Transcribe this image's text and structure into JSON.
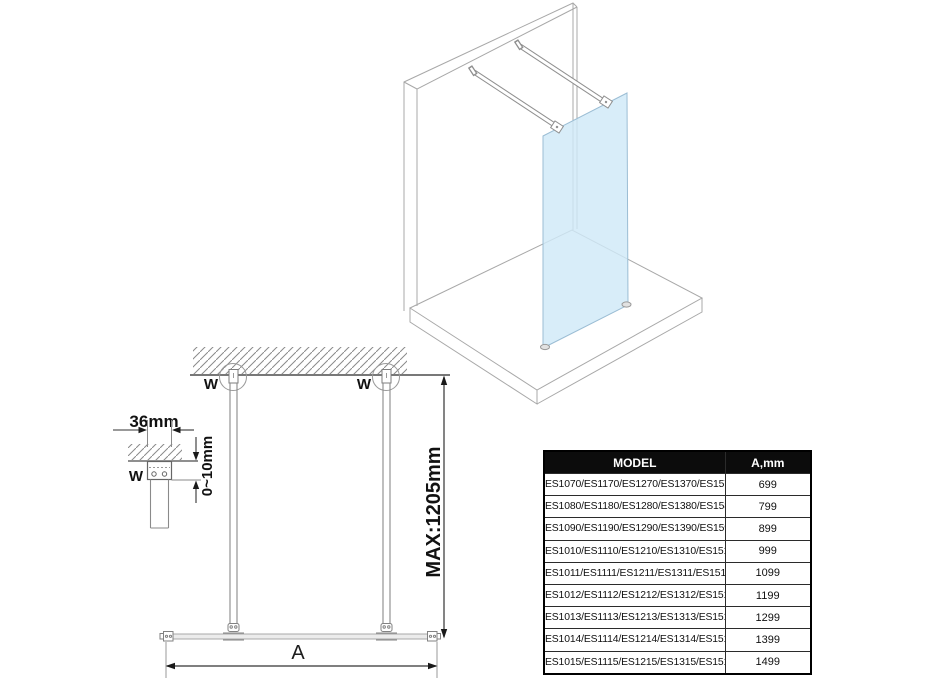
{
  "drawing_3d": {
    "name": "isometric-walk-in-glass-panel",
    "glass_color": "#CFE9F8",
    "outline_color": "#A8A8A8",
    "elements": [
      "wall-slab",
      "floor-slab",
      "glass-panel",
      "support-bar-front",
      "support-bar-back",
      "glass-feet"
    ]
  },
  "drawing_2d": {
    "labels": {
      "wall_mount_left": "W",
      "wall_mount_right": "W",
      "wall_mount_detail": "W",
      "bar_width": "36mm",
      "adjust_range": "0~10mm",
      "max_length": "MAX:1205mm",
      "glass_width": "A"
    }
  },
  "table": {
    "headers": {
      "model": "MODEL",
      "a_mm": "A,mm"
    },
    "header_bg": "#0c0c0c",
    "header_text_color": "#ffffff",
    "rows": [
      {
        "model": "ES1070/ES1170/ES1270/ES1370/ES1570",
        "a_mm": "699"
      },
      {
        "model": "ES1080/ES1180/ES1280/ES1380/ES1580",
        "a_mm": "799"
      },
      {
        "model": "ES1090/ES1190/ES1290/ES1390/ES1590",
        "a_mm": "899"
      },
      {
        "model": "ES1010/ES1110/ES1210/ES1310/ES1510",
        "a_mm": "999"
      },
      {
        "model": "ES1011/ES1111/ES1211/ES1311/ES1511",
        "a_mm": "1099"
      },
      {
        "model": "ES1012/ES1112/ES1212/ES1312/ES1512",
        "a_mm": "1199"
      },
      {
        "model": "ES1013/ES1113/ES1213/ES1313/ES1513",
        "a_mm": "1299"
      },
      {
        "model": "ES1014/ES1114/ES1214/ES1314/ES1514",
        "a_mm": "1399"
      },
      {
        "model": "ES1015/ES1115/ES1215/ES1315/ES1515",
        "a_mm": "1499"
      }
    ]
  }
}
